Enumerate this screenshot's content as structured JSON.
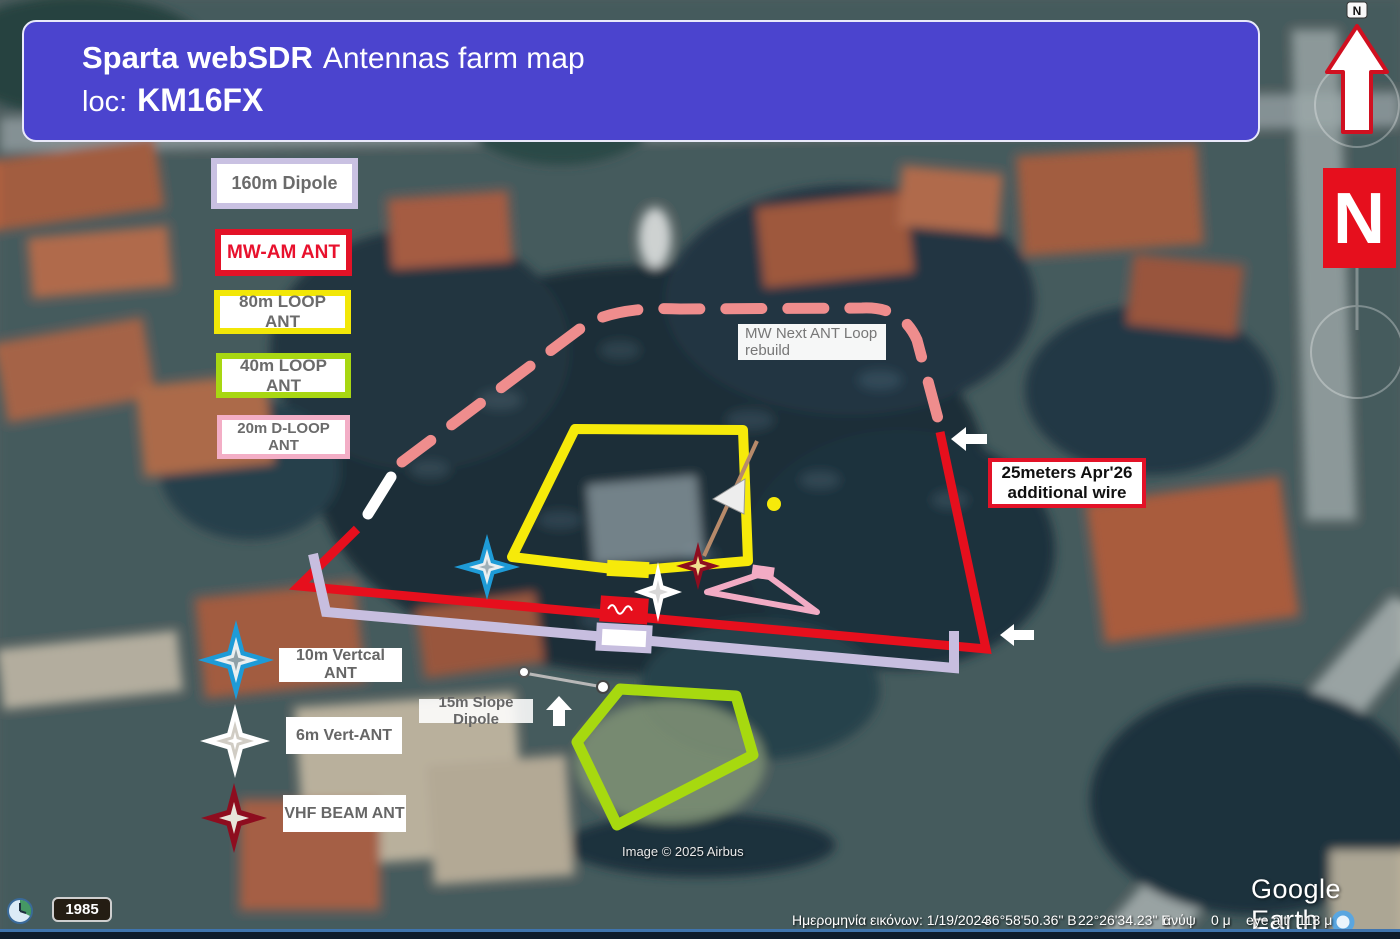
{
  "banner": {
    "title_bold": "Sparta webSDR",
    "title_rest": "Antennas farm map",
    "loc_label": "loc:",
    "loc_value": "KM16FX",
    "bg_color": "#4b44ce"
  },
  "legend": {
    "items": [
      {
        "label": "160m Dipole",
        "border_color": "#c9c1e2"
      },
      {
        "label": "MW-AM ANT",
        "border_color": "#e31227"
      },
      {
        "label": "80m LOOP ANT",
        "border_color": "#f2e707"
      },
      {
        "label": "40m LOOP ANT",
        "border_color": "#a8d712"
      },
      {
        "label": "20m D-LOOP ANT",
        "border_color": "#f3aec6"
      }
    ]
  },
  "map_labels": {
    "mw_next_line1": "MW Next ANT Loop",
    "mw_next_line2": "rebuild",
    "wire25_line1": "25meters Apr'26",
    "wire25_line2": "additional wire",
    "vertical_10m": "10m Vertcal ANT",
    "vert_6m": "6m Vert-ANT",
    "vhf_beam": "VHF BEAM ANT",
    "slope_15m": "15m Slope Dipole"
  },
  "compass": {
    "n_box_label": "N",
    "n_small_label": "N"
  },
  "overlay_colors": {
    "red": "#e60f1d",
    "yellow": "#f6ea0a",
    "green": "#a7d90f",
    "lavender": "#c7bedf",
    "pink_dash": "#ef8d8d",
    "pink_triangle": "#f2abc4",
    "blue_star": "#1e9bd7",
    "dark_red_star": "#8e0d1f"
  },
  "watermarks": {
    "imagery_credit": "Image © 2025 Airbus",
    "brand": "Google Earth"
  },
  "timeline": {
    "year": "1985"
  },
  "statusbar": {
    "imagery_date": "Ημερομηνία εικόνων: 1/19/2024",
    "latitude": "36°58'50.36\" Β",
    "longitude": "22°26'34.23\" Ε",
    "elev_label": "ανύψ",
    "elev_value": "0 μ",
    "eye_alt_label": "eye alt",
    "eye_alt_value": "113 μ"
  }
}
